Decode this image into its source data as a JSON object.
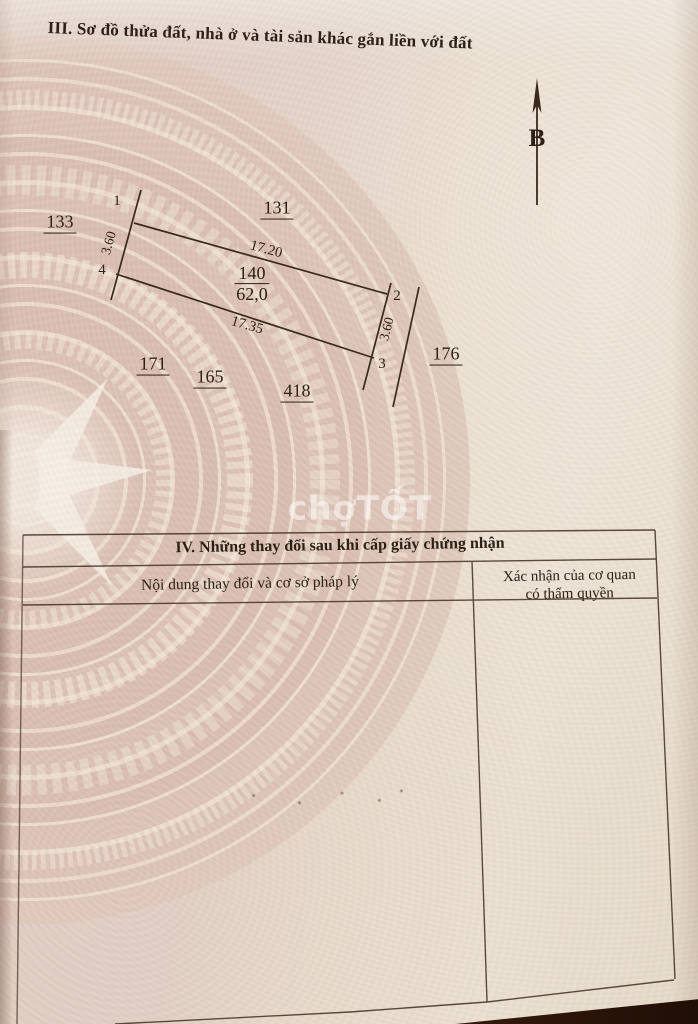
{
  "header": {
    "section3_title": "III. Sơ đồ thửa đất, nhà ở và tài sản khác gắn liền với đất"
  },
  "diagram": {
    "north_label": "B",
    "plot_number": "140",
    "plot_area": "62,0",
    "len_top": "17.20",
    "len_bottom": "17.35",
    "width_left": "3.60",
    "width_right": "3.60",
    "corner_1": "1",
    "corner_2": "2",
    "corner_3": "3",
    "corner_4": "4",
    "neighbor_left": "133",
    "neighbor_top": "131",
    "neighbor_right": "176",
    "neighbor_bottom_1": "171",
    "neighbor_bottom_2": "165",
    "neighbor_bottom_3": "418"
  },
  "watermark": {
    "text": "chợTỐT"
  },
  "table": {
    "title": "IV. Những thay đổi sau khi cấp giấy chứng nhận",
    "col_content_header": "Nội dung thay đổi và cơ sở pháp lý",
    "col_authority_line1": "Xác nhận của cơ quan",
    "col_authority_line2": "có thẩm quyền"
  },
  "colors": {
    "ink": "#2c2017",
    "boundary_line": "#3a2a1e",
    "table_line": "#4a382a",
    "paper_pink": "#dcc1b6",
    "paper_cream": "#e8dccd",
    "desk_dark": "#2a1207",
    "watermark": "#ffffff"
  }
}
